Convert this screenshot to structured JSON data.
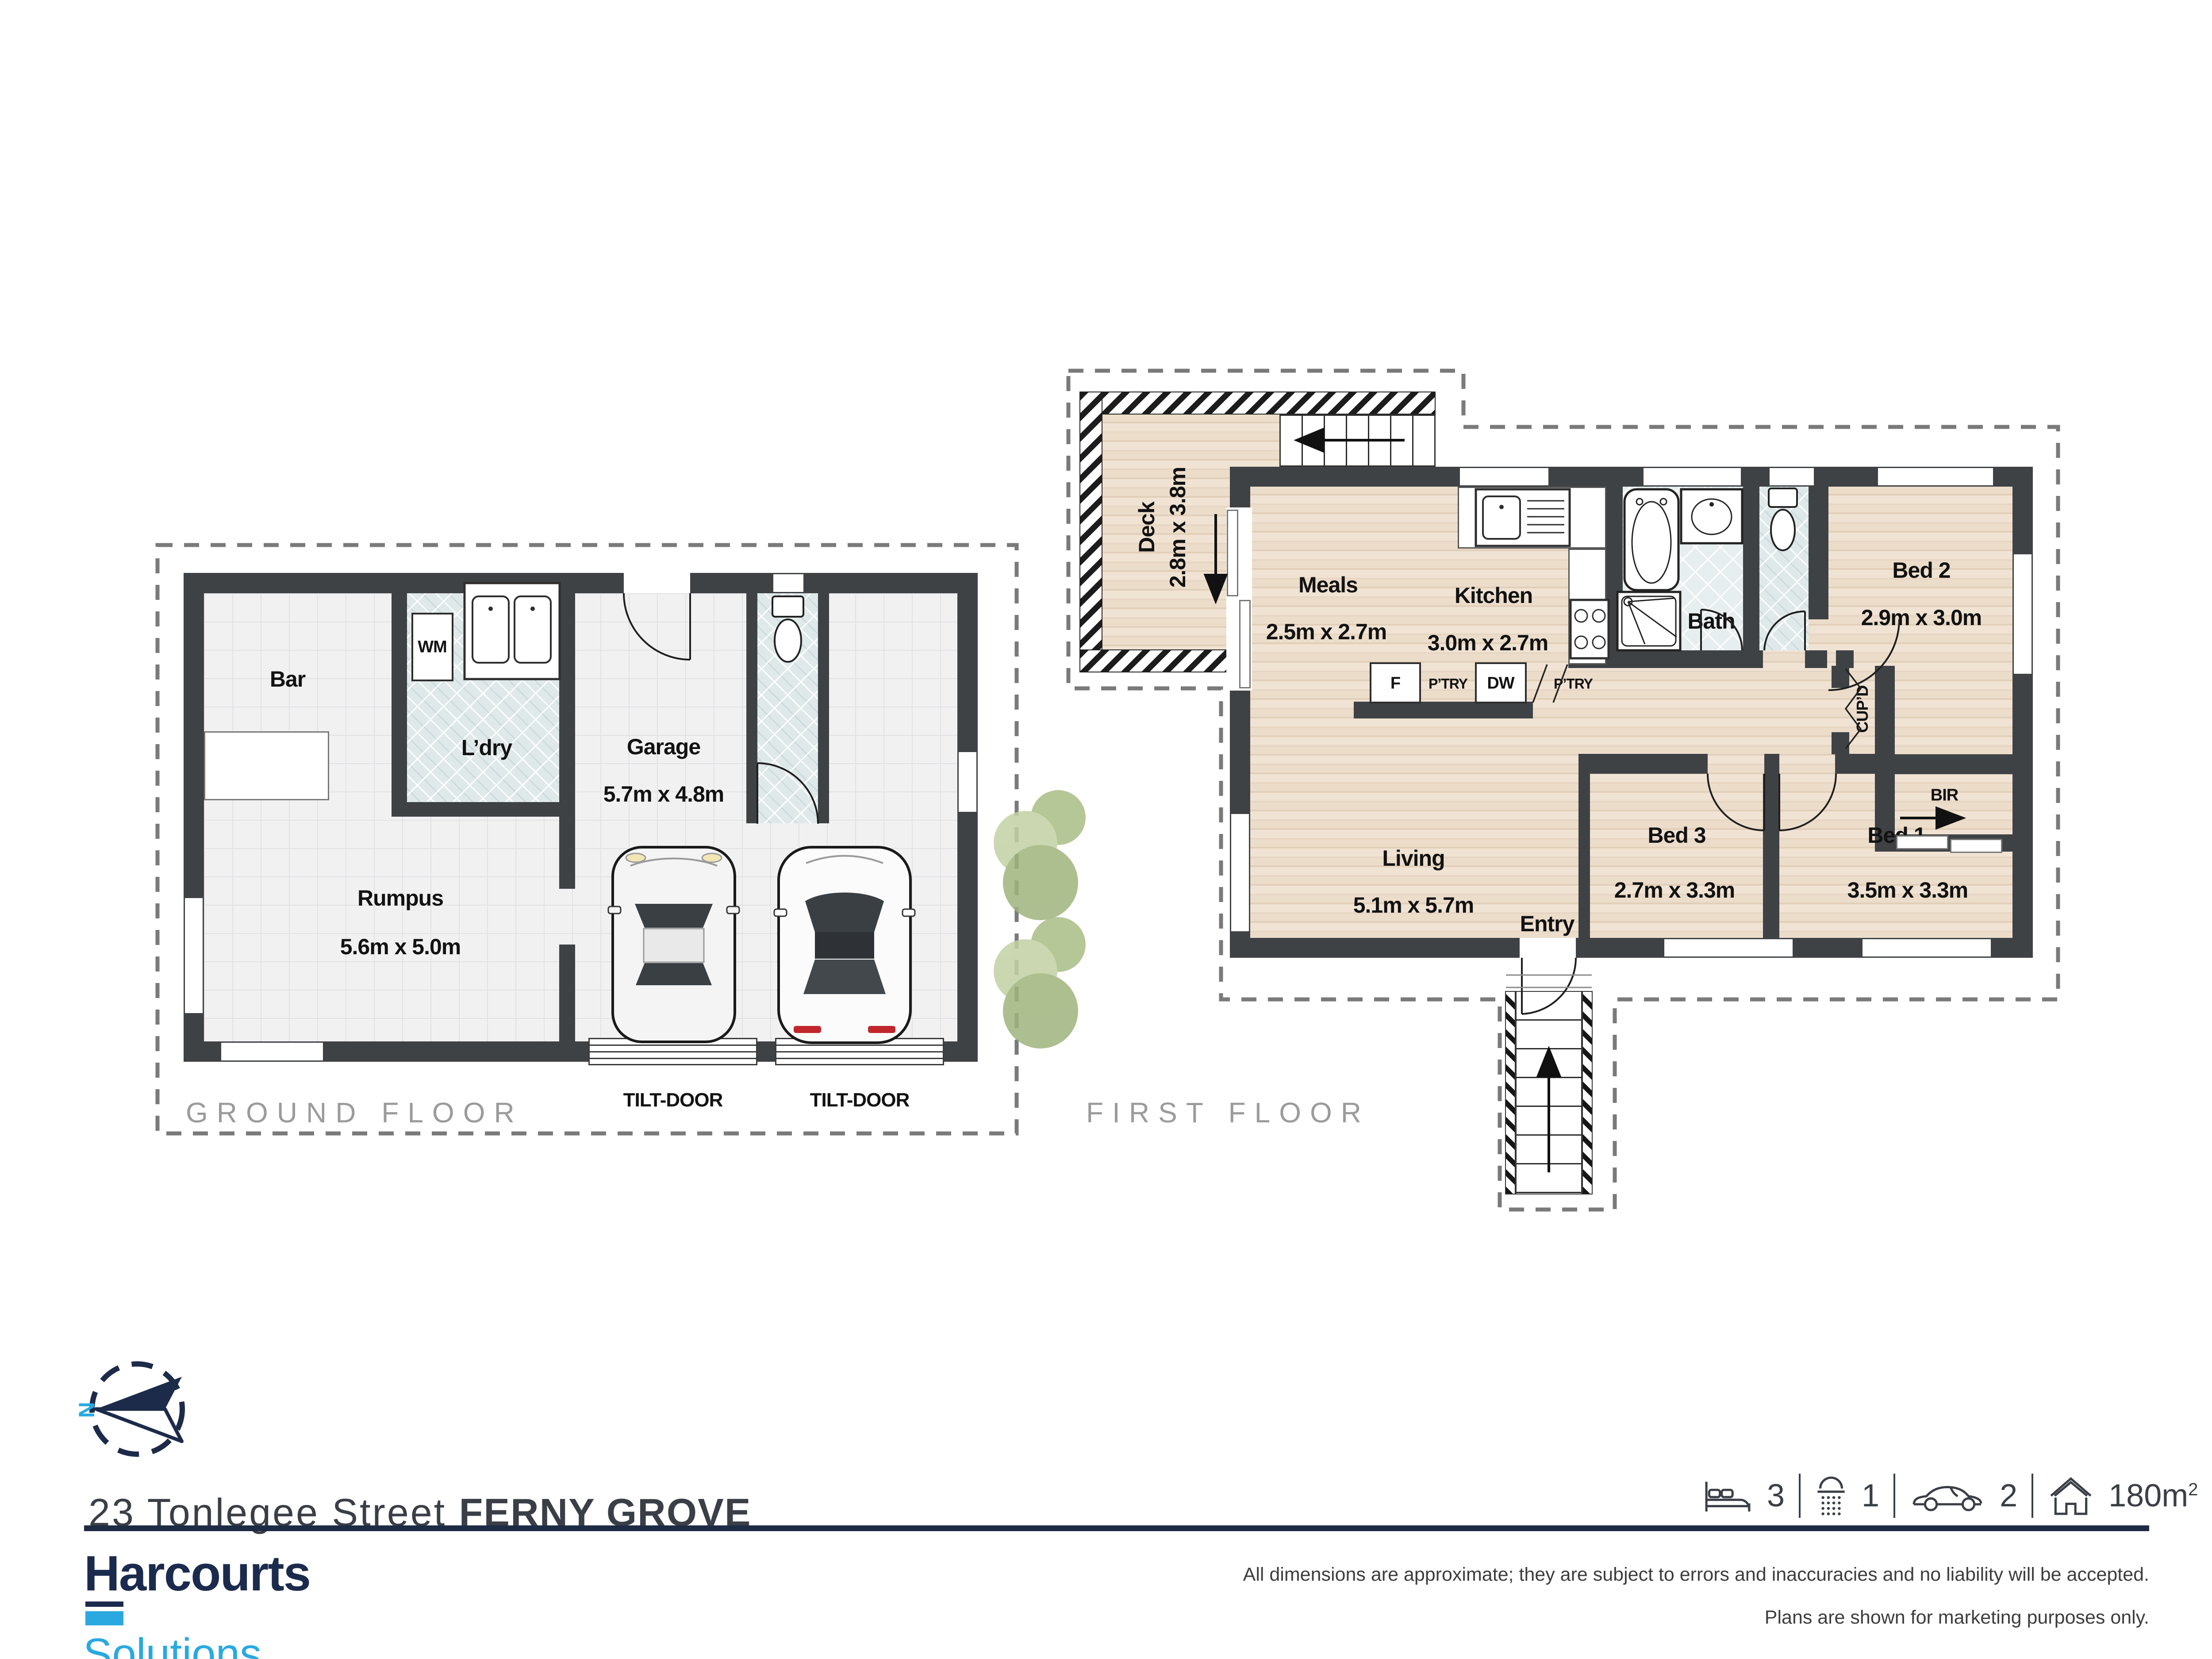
{
  "colors": {
    "wall": "#3f4245",
    "brand_navy": "#1b2b4d",
    "brand_cyan": "#29a9e1",
    "caption_gray": "#9b9b9b",
    "tile_blue": "#dfe9ea",
    "wood": "#e9d8c5"
  },
  "ground_floor": {
    "caption": "GROUND FLOOR",
    "labels": {
      "bar": {
        "name": "Bar"
      },
      "ldry": {
        "name": "L’dry"
      },
      "wm": "WM",
      "garage": {
        "name": "Garage",
        "dims": "5.7m x 4.8m"
      },
      "rumpus": {
        "name": "Rumpus",
        "dims": "5.6m x 5.0m"
      },
      "tilt_left": "TILT-DOOR",
      "tilt_right": "TILT-DOOR"
    }
  },
  "first_floor": {
    "caption": "FIRST FLOOR",
    "labels": {
      "deck": {
        "name": "Deck",
        "dims": "2.8m x 3.8m"
      },
      "meals": {
        "name": "Meals",
        "dims": "2.5m x 2.7m"
      },
      "kitchen": {
        "name": "Kitchen",
        "dims": "3.0m x 2.7m"
      },
      "bath": {
        "name": "Bath"
      },
      "bed2": {
        "name": "Bed 2",
        "dims": "2.9m x 3.0m"
      },
      "living": {
        "name": "Living",
        "dims": "5.1m x 5.7m"
      },
      "bed3": {
        "name": "Bed 3",
        "dims": "2.7m x 3.3m"
      },
      "bed1": {
        "name": "Bed 1",
        "dims": "3.5m x 3.3m"
      },
      "entry": {
        "name": "Entry"
      },
      "fridge": "F",
      "dw": "DW",
      "ptry_left": "P’TRY",
      "ptry_right": "P’TRY",
      "cupd": "CUP’D",
      "bir": "BIR"
    }
  },
  "footer": {
    "compass_n": "N",
    "address_street": "23 Tonlegee Street ",
    "address_suburb": "FERNY GROVE",
    "stats": {
      "beds": "3",
      "baths": "1",
      "cars": "2",
      "area": "180m",
      "area_sup": "2"
    },
    "brand": {
      "line1": "Harcourts",
      "line2": "Solutions"
    },
    "disclaimer_line1": "All dimensions are approximate; they are subject to errors and inaccuracies and no liability will be accepted.",
    "disclaimer_line2": "Plans are shown for marketing purposes only."
  }
}
